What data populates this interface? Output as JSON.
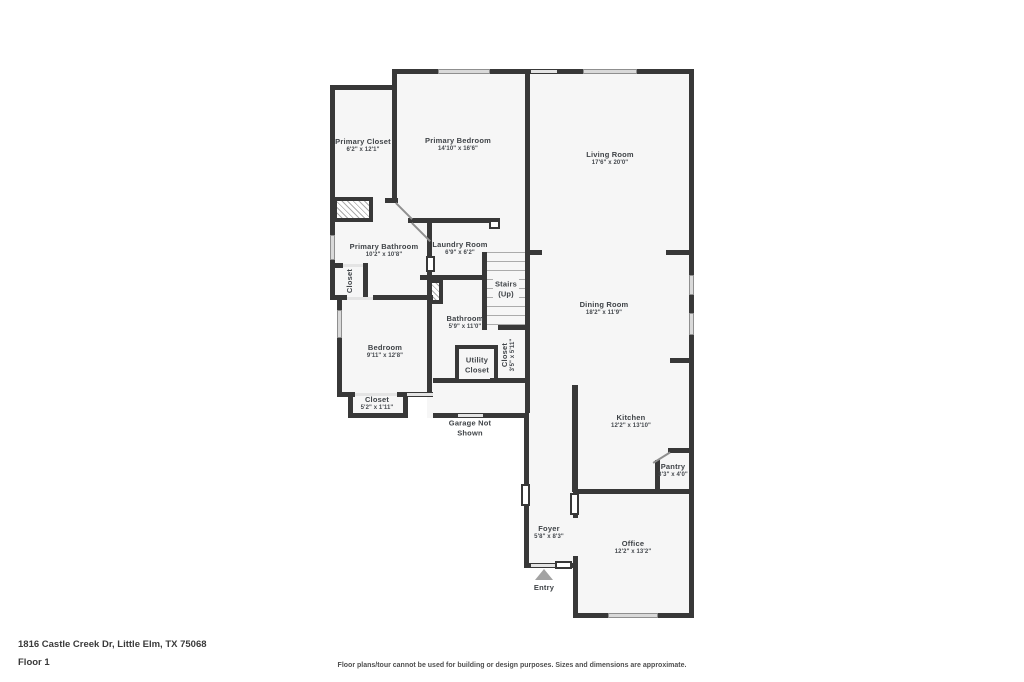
{
  "plan": {
    "wall_color": "#383838",
    "floor_color": "#f6f6f6",
    "window_color": "#d9d9d9",
    "label_color": "#3f4347"
  },
  "rooms": [
    {
      "name": "Primary Closet",
      "dims": "6'2\" x 12'1\""
    },
    {
      "name": "Primary Bedroom",
      "dims": "14'10\" x 16'6\""
    },
    {
      "name": "Living Room",
      "dims": "17'6\" x 20'0\""
    },
    {
      "name": "Primary Bathroom",
      "dims": "10'2\" x 10'8\""
    },
    {
      "name": "Laundry Room",
      "dims": "6'9\" x 6'2\""
    },
    {
      "name": "Stairs",
      "dims": "(Up)"
    },
    {
      "name": "Dining Room",
      "dims": "18'2\" x 11'9\""
    },
    {
      "name": "Bathroom",
      "dims": "5'9\" x 11'0\""
    },
    {
      "name": "Closet",
      "dims": ""
    },
    {
      "name": "Bedroom",
      "dims": "9'11\" x 12'8\""
    },
    {
      "name": "Utility Closet",
      "dims": ""
    },
    {
      "name": "Closet",
      "dims": "3'5\" x 5'11\""
    },
    {
      "name": "Closet",
      "dims": "5'2\" x 1'11\""
    },
    {
      "name": "Garage Not Shown",
      "dims": ""
    },
    {
      "name": "Kitchen",
      "dims": "12'2\" x 13'10\""
    },
    {
      "name": "Pantry",
      "dims": "3'3\" x 4'0\""
    },
    {
      "name": "Foyer",
      "dims": "5'8\" x 8'3\""
    },
    {
      "name": "Office",
      "dims": "12'2\" x 13'2\""
    },
    {
      "name": "Entry",
      "dims": ""
    }
  ],
  "footer": {
    "address": "1816 Castle Creek Dr, Little Elm, TX 75068",
    "floor_label": "Floor 1",
    "disclaimer": "Floor plans/tour cannot be used for building or design purposes. Sizes and dimensions are approximate."
  }
}
